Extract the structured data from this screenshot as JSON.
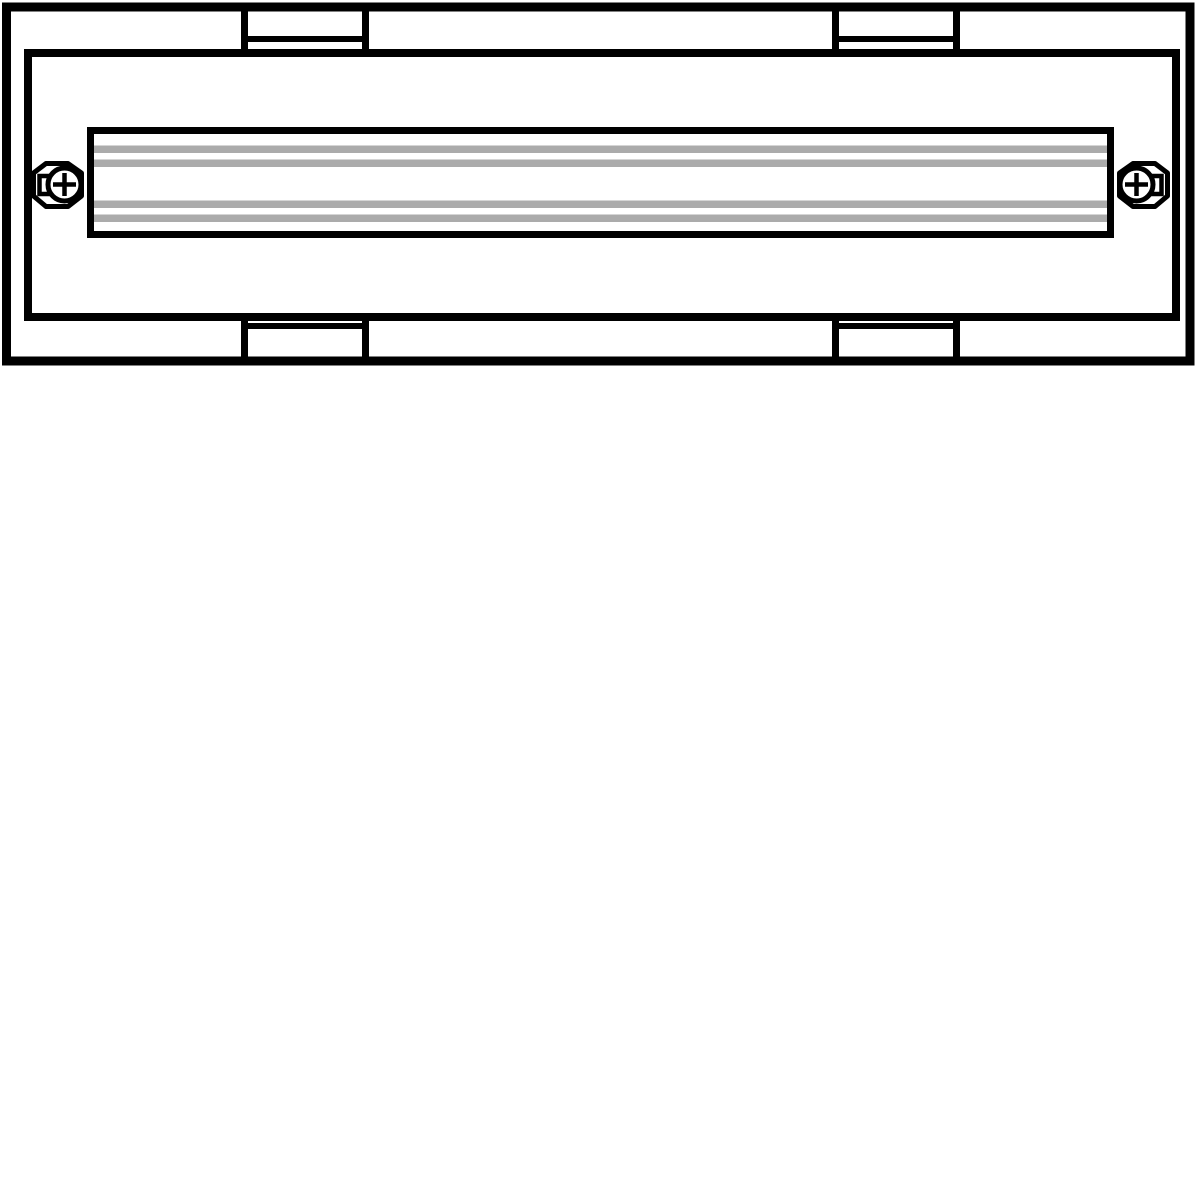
{
  "page": {
    "background": "#ffffff"
  },
  "drawing": {
    "description": "Technical line drawing, front view: rectangular enclosure frame with four mounting tabs, horizontal DIN rail with four gray grooves, and two oval fixing screws with Phillips cross heads",
    "canvas": {
      "width": 1200,
      "height": 1200
    },
    "colors": {
      "line": "#000000",
      "fill": "#ffffff",
      "stripe": "#ababab"
    },
    "outer_frame": {
      "x": 6.5,
      "y": 7,
      "width": 1183.5,
      "height": 354,
      "stroke_width": 9
    },
    "inner_frame": {
      "x": 28,
      "y": 53,
      "width": 1148,
      "height": 264,
      "stroke_width": 8
    },
    "mounting_tabs": {
      "stroke_width": 7,
      "divider_stroke_width": 6,
      "columns": [
        {
          "left": 244.5,
          "right": 365.5
        },
        {
          "left": 835.5,
          "right": 956.5
        }
      ],
      "top": {
        "y_start": 7,
        "y_end": 57,
        "divider_y": 39
      },
      "bottom": {
        "y_start": 313,
        "y_end": 361,
        "divider_y": 326
      }
    },
    "din_rail": {
      "x": 90.5,
      "y": 130.5,
      "width": 1020,
      "height": 104,
      "stroke_width": 7,
      "stripes": {
        "x": 94,
        "width": 1013,
        "height": 7.5,
        "y_positions": [
          145.5,
          159.5,
          200.5,
          214.5
        ]
      }
    },
    "screws": {
      "stroke_width": 5,
      "cross_stroke_width": 4.5,
      "head_radius": 16.5,
      "cross_arm": 11.5,
      "octagon_points": [
        [
          -18.5,
          -21
        ],
        [
          3.5,
          -21
        ],
        [
          17,
          -11.5
        ],
        [
          17,
          11.5
        ],
        [
          3.5,
          22
        ],
        [
          -18.5,
          22
        ],
        [
          -31,
          11.5
        ],
        [
          -31,
          -11.5
        ]
      ],
      "notch": {
        "x": -25,
        "y": -8.5,
        "width": 16,
        "height": 18
      },
      "instances": [
        {
          "side": "left",
          "cx": 64.5,
          "cy": 184.5,
          "mirrored": false
        },
        {
          "side": "right",
          "cx": 1136.5,
          "cy": 184.5,
          "mirrored": true
        }
      ]
    }
  }
}
